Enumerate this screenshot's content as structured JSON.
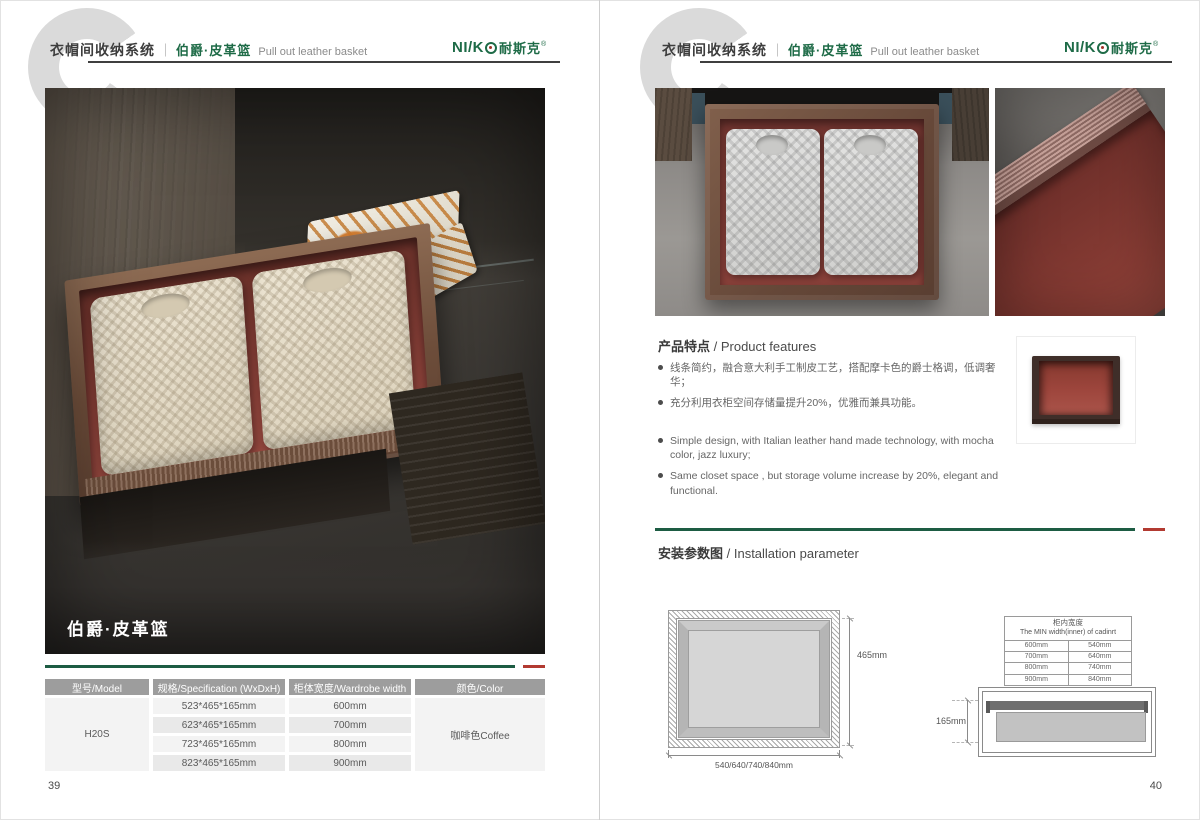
{
  "brand": {
    "logo_latin": "NI/K",
    "logo_cn": "耐斯克",
    "logo_reg": "®",
    "green": "#1e6b47",
    "red": "#b23a31"
  },
  "header": {
    "title_cn": "衣帽间收纳系统",
    "separator": "｜",
    "subtitle_cn": "伯爵·皮革篮",
    "subtitle_en": "Pull out leather basket"
  },
  "left_page": {
    "page_number": "39",
    "photo_label": "伯爵·皮革篮",
    "table": {
      "headers": [
        "型号/Model",
        "规格/Specification (WxDxH)",
        "柜体宽度/Wardrobe width",
        "颜色/Color"
      ],
      "model": "H20S",
      "rows": [
        {
          "spec": "523*465*165mm",
          "width": "600mm"
        },
        {
          "spec": "623*465*165mm",
          "width": "700mm"
        },
        {
          "spec": "723*465*165mm",
          "width": "800mm"
        },
        {
          "spec": "823*465*165mm",
          "width": "900mm"
        }
      ],
      "color": "咖啡色Coffee"
    }
  },
  "right_page": {
    "page_number": "40",
    "features": {
      "title_cn": "产品特点",
      "title_en": " / Product features",
      "bullets_cn": [
        "线条简约，融合意大利手工制皮工艺，搭配摩卡色的爵士格调，低调奢华；",
        "充分利用衣柜空间存储量提升20%，优雅而兼具功能。"
      ],
      "bullets_en": [
        "Simple design, with Italian leather hand made technology, with mocha color, jazz  luxury;",
        "Same closet space ,  but storage volume increase by 20%, elegant and functional."
      ]
    },
    "installation": {
      "title_cn": "安装参数图",
      "title_en": " / Installation parameter",
      "top_view": {
        "dim_height": "465mm",
        "dim_width": "540/640/740/840mm"
      },
      "min_width_table": {
        "title_cn": "柜内宽度",
        "title_en": "The MIN width(inner) of cadinrt",
        "rows": [
          [
            "600mm",
            "540mm"
          ],
          [
            "700mm",
            "640mm"
          ],
          [
            "800mm",
            "740mm"
          ],
          [
            "900mm",
            "840mm"
          ]
        ]
      },
      "side_view": {
        "dim_height": "165mm"
      }
    }
  }
}
